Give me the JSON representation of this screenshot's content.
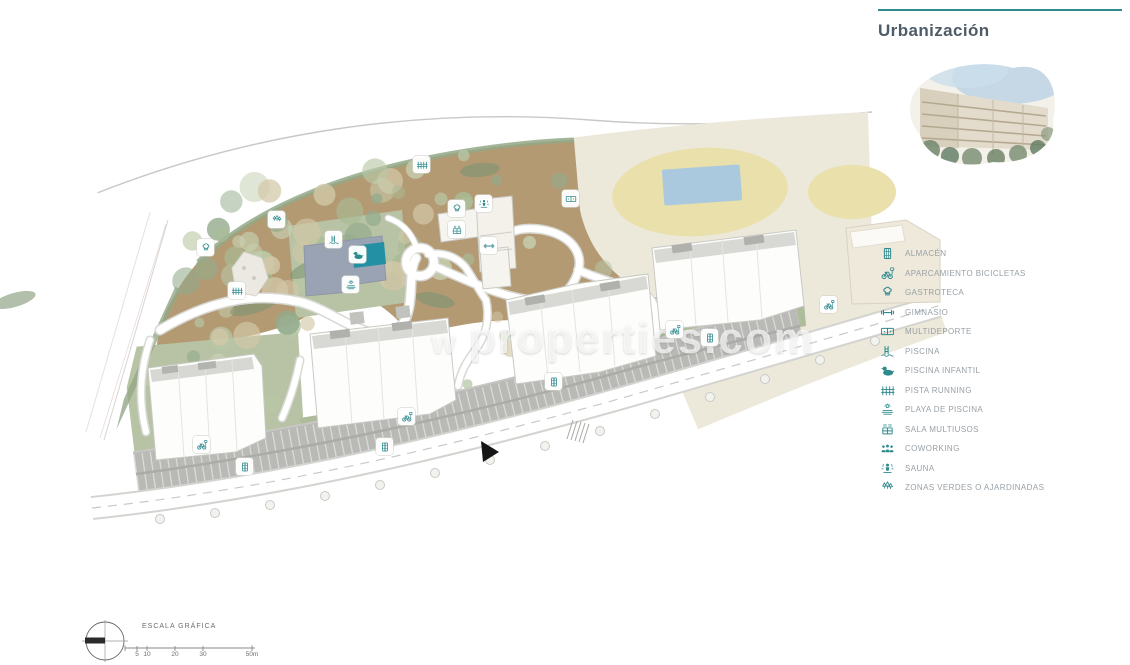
{
  "header": {
    "title": "Urbanización"
  },
  "legend": {
    "items": [
      {
        "label": "ALMACÉN",
        "icon": "almacen-icon"
      },
      {
        "label": "APARCAMIENTO BICICLETAS",
        "icon": "bicycle-icon"
      },
      {
        "label": "GASTROTECA",
        "icon": "chef-hat-icon"
      },
      {
        "label": "GIMNASIO",
        "icon": "dumbbell-icon"
      },
      {
        "label": "MULTIDEPORTE",
        "icon": "sports-court-icon"
      },
      {
        "label": "PISCINA",
        "icon": "pool-ladder-icon"
      },
      {
        "label": "PISCINA INFANTIL",
        "icon": "duck-icon"
      },
      {
        "label": "PISTA RUNNING",
        "icon": "running-track-icon"
      },
      {
        "label": "PLAYA DE PISCINA",
        "icon": "sun-deck-icon"
      },
      {
        "label": "SALA MULTIUSOS",
        "icon": "multiuse-hall-icon"
      },
      {
        "label": "COWORKING",
        "icon": "people-icon"
      },
      {
        "label": "SAUNA",
        "icon": "sauna-icon"
      },
      {
        "label": "ZONAS VERDES O AJARDINADAS",
        "icon": "trees-icon"
      }
    ]
  },
  "map": {
    "watermark_prefix": "w",
    "watermark": "properties.com",
    "markers": [
      {
        "name": "zonas-verdes",
        "icon": "trees",
        "x": 268,
        "y": 211
      },
      {
        "name": "gastroteca-park",
        "icon": "chef",
        "x": 197,
        "y": 239
      },
      {
        "name": "pista-running-1",
        "icon": "track",
        "x": 228,
        "y": 282
      },
      {
        "name": "pista-running-2",
        "icon": "track",
        "x": 413,
        "y": 156
      },
      {
        "name": "piscina",
        "icon": "ladder",
        "x": 325,
        "y": 231
      },
      {
        "name": "piscina-infantil",
        "icon": "duck",
        "x": 349,
        "y": 246
      },
      {
        "name": "playa-de-piscina",
        "icon": "sun",
        "x": 342,
        "y": 276
      },
      {
        "name": "gastroteca-club",
        "icon": "chef",
        "x": 448,
        "y": 200
      },
      {
        "name": "sauna",
        "icon": "sauna",
        "x": 475,
        "y": 195
      },
      {
        "name": "sala-multiusos",
        "icon": "hall",
        "x": 448,
        "y": 221
      },
      {
        "name": "gimnasio",
        "icon": "dumbbell",
        "x": 480,
        "y": 237
      },
      {
        "name": "multideporte",
        "icon": "court",
        "x": 562,
        "y": 190
      },
      {
        "name": "aparcamiento-bicicletas-1",
        "icon": "bike",
        "x": 193,
        "y": 436
      },
      {
        "name": "almacen-1",
        "icon": "almacen",
        "x": 236,
        "y": 458
      },
      {
        "name": "aparcamiento-bicicletas-2",
        "icon": "bike",
        "x": 398,
        "y": 408
      },
      {
        "name": "almacen-2",
        "icon": "almacen",
        "x": 376,
        "y": 438
      },
      {
        "name": "almacen-3",
        "icon": "almacen",
        "x": 545,
        "y": 373
      },
      {
        "name": "aparcamiento-bicicletas-3",
        "icon": "bike",
        "x": 666,
        "y": 321
      },
      {
        "name": "almacen-4",
        "icon": "almacen",
        "x": 701,
        "y": 329
      },
      {
        "name": "aparcamiento-bicicletas-4",
        "icon": "bike",
        "x": 820,
        "y": 296
      }
    ]
  },
  "scale_bar": {
    "label": "ESCALA GRÁFICA",
    "ticks": [
      "5",
      "10",
      "20",
      "30",
      "50m"
    ]
  },
  "colors": {
    "c-accent": "#2f8a8e",
    "c-title": "#4e5c68",
    "c-legend-text": "#98a0a6",
    "c-tan": "#b49a73",
    "c-cream": "#ece8da",
    "c-sand": "#e9e0ac",
    "c-pool-blue": "#aac9de",
    "c-spa-pool": "#2391a3",
    "c-lawn": "#b7c3a4",
    "c-hedge": "#9db289",
    "c-parking": "#b9b9b6",
    "c-building": "#fdfdfb",
    "c-watermark": "rgba(255,255,255,0.68)"
  }
}
